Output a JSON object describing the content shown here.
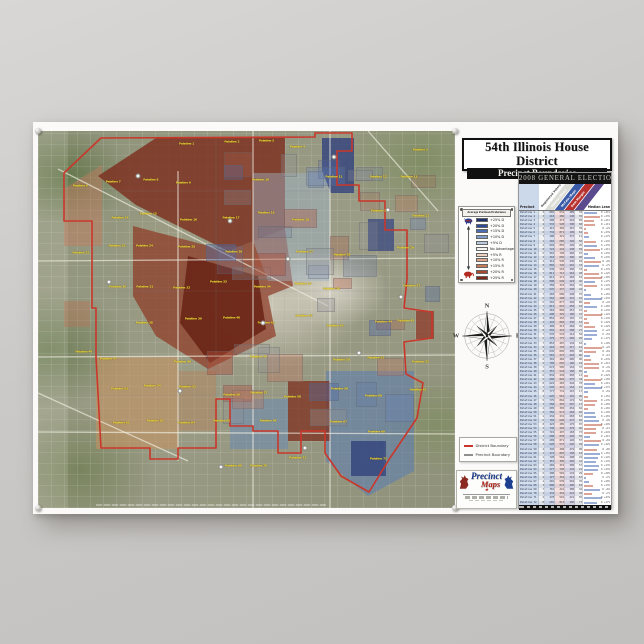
{
  "poster": {
    "title": "54th Illinois House District",
    "subtitle": "Precinct Boundaries"
  },
  "map": {
    "precinct_label_prefix": "Palatine",
    "district_boundary_color": "#c9372b",
    "shields": [
      {
        "x": 24,
        "y": 12
      },
      {
        "x": 46,
        "y": 24
      },
      {
        "x": 60,
        "y": 34
      },
      {
        "x": 71,
        "y": 7
      },
      {
        "x": 84,
        "y": 21
      },
      {
        "x": 17,
        "y": 40
      },
      {
        "x": 54,
        "y": 51
      },
      {
        "x": 77,
        "y": 59
      },
      {
        "x": 34,
        "y": 69
      },
      {
        "x": 64,
        "y": 84
      },
      {
        "x": 87,
        "y": 44
      },
      {
        "x": 44,
        "y": 89
      }
    ]
  },
  "legend": {
    "title": "Average Partisan Preference",
    "entries": [
      {
        "label": "+25% D",
        "color": "#1e2f6d"
      },
      {
        "label": "+20% D",
        "color": "#2c4a9a"
      },
      {
        "label": "+15% D",
        "color": "#4a6cb3"
      },
      {
        "label": "+10% D",
        "color": "#7e9bca"
      },
      {
        "label": "+5% D",
        "color": "#b9cbe0"
      },
      {
        "label": "No Advantage",
        "color": "#f4f4f0"
      },
      {
        "label": "+5% R",
        "color": "#f0d2c2"
      },
      {
        "label": "+10% R",
        "color": "#dfa58b"
      },
      {
        "label": "+15% R",
        "color": "#c97a58"
      },
      {
        "label": "+20% R",
        "color": "#a74a30"
      },
      {
        "label": "+25% R",
        "color": "#7c2715"
      }
    ]
  },
  "election_table": {
    "title": "2008 General Election",
    "precinct_column": "Precinct",
    "lean_column": "Median Lean",
    "diagonal_columns": [
      {
        "label": "Registered Voters",
        "color": "#dcdcd6",
        "text_color": "#444444"
      },
      {
        "label": "Obama (Dem)",
        "color": "#3a5ba8",
        "text_color": "#ffffff"
      },
      {
        "label": "McCain (Rep)",
        "color": "#b93230",
        "text_color": "#ffffff"
      },
      {
        "label": "Dem Margin",
        "color": "#5b4a8e",
        "text_color": "#ffffff"
      }
    ],
    "row_count": 72
  },
  "compass": {
    "n": "N",
    "s": "S",
    "e": "E",
    "w": "W"
  },
  "boundary_key": [
    {
      "label": "District Boundary",
      "color": "#c9372b"
    },
    {
      "label": "Precinct Boundary",
      "color": "#8f8f8f"
    }
  ],
  "logo": {
    "word1": "Precinct",
    "word2": "Maps",
    "star": "★"
  }
}
